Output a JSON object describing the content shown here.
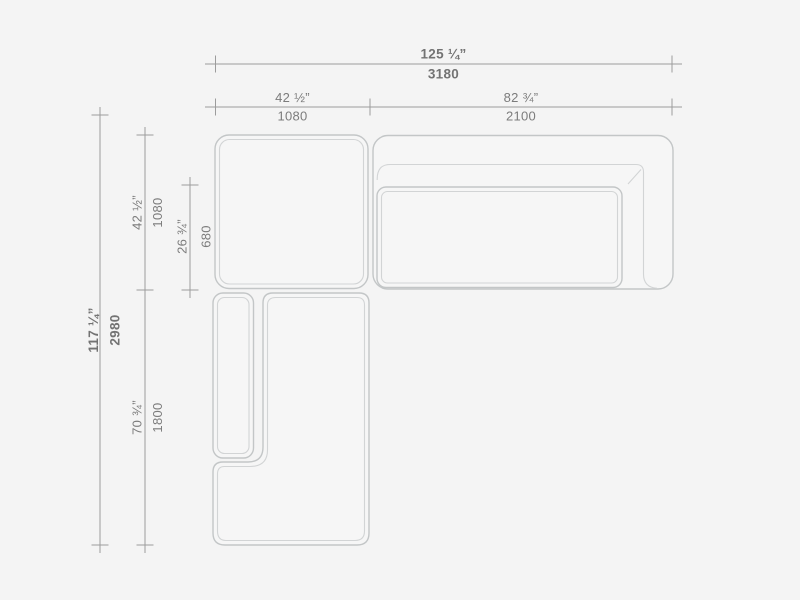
{
  "drawing": {
    "title": "sectional-sofa-top-view-dimension-drawing",
    "colors": {
      "background": "#f4f4f4",
      "furniture_outline": "#c3c6c7",
      "furniture_inner_line": "#d2d4d5",
      "furniture_fill": "#f6f6f6",
      "dimension_line": "#9c9c9c",
      "dimension_text": "#7c7c7c"
    }
  },
  "dimensions": {
    "overall_width": {
      "inches": "125 ¼”",
      "mm": "3180"
    },
    "top_left_width": {
      "inches": "42 ½”",
      "mm": "1080"
    },
    "top_right_width": {
      "inches": "82 ¾”",
      "mm": "2100"
    },
    "overall_height": {
      "inches": "117 ¼”",
      "mm": "2980"
    },
    "upper_left_height": {
      "inches": "42 ½”",
      "mm": "1080"
    },
    "inner_left_height": {
      "inches": "26 ¾”",
      "mm": "680"
    },
    "lower_left_height": {
      "inches": "70 ¾”",
      "mm": "1800"
    }
  }
}
